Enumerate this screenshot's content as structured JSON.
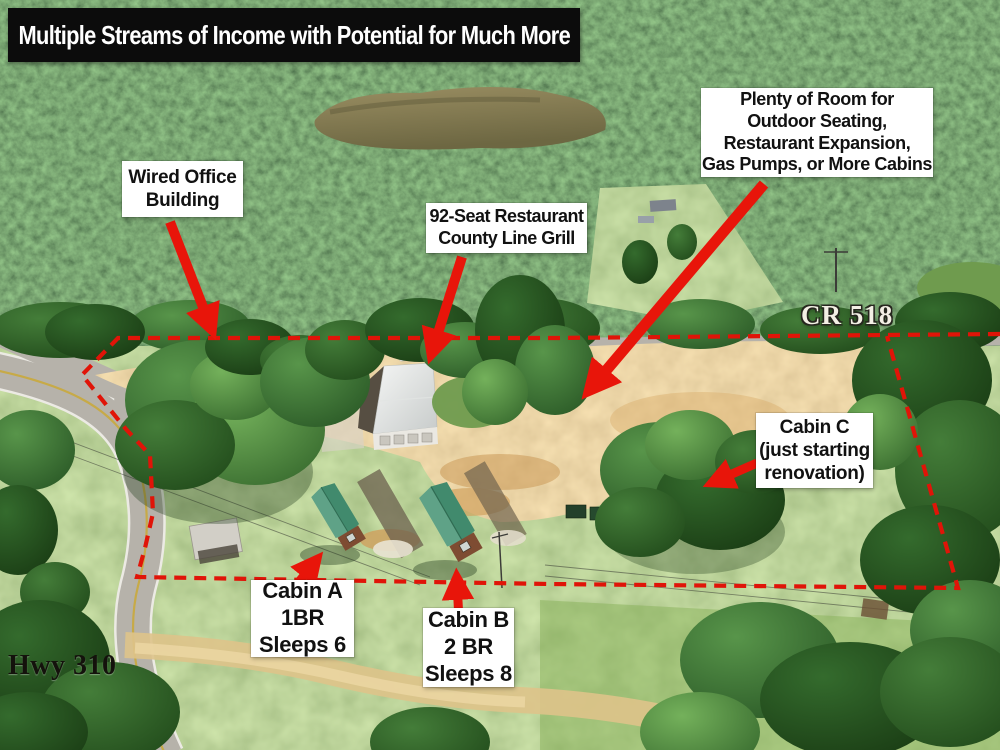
{
  "banner": {
    "title": "Multiple Streams of Income with Potential for Much More"
  },
  "callouts": {
    "wired_office": {
      "lines": [
        "Wired Office",
        "Building"
      ]
    },
    "restaurant": {
      "lines": [
        "92-Seat Restaurant",
        "County Line Grill"
      ]
    },
    "expansion": {
      "lines": [
        "Plenty of Room for",
        "Outdoor Seating,",
        "Restaurant Expansion,",
        "Gas Pumps, or More Cabins"
      ]
    },
    "cabin_c": {
      "lines": [
        "Cabin C",
        "(just starting",
        "renovation)"
      ]
    },
    "cabin_a": {
      "lines": [
        "Cabin A",
        "1BR",
        "Sleeps 6"
      ]
    },
    "cabin_b": {
      "lines": [
        "Cabin B",
        "2 BR",
        "Sleeps 8"
      ]
    }
  },
  "road_labels": {
    "county_road": "CR 518",
    "highway": "Hwy 310"
  },
  "colors": {
    "annotation_red": "#e8150a",
    "boundary_red": "#e01408",
    "banner_bg": "#0c0c0c",
    "banner_text": "#ffffff",
    "label_bg": "#ffffff",
    "label_text": "#111111"
  }
}
